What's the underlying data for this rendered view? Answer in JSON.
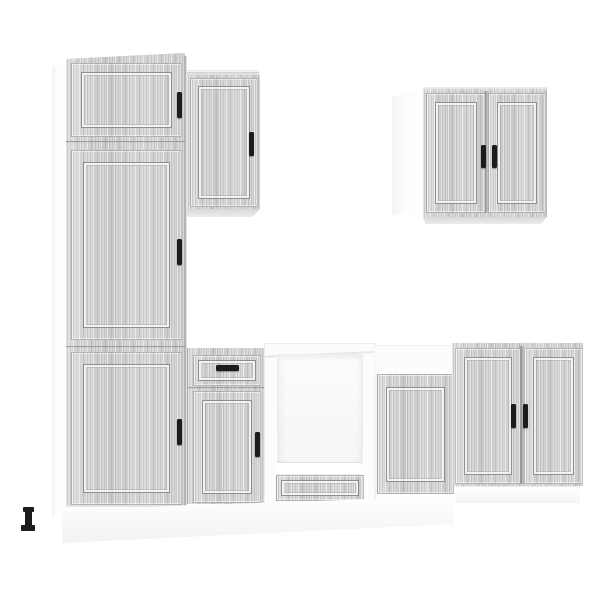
{
  "scene": {
    "description": "Product photo of a 7-piece kitchen cabinet set in grey sonoma wood-grain finish with white carcasses, on a plain white background",
    "text_visible": "none"
  },
  "colors": {
    "background": "#ffffff",
    "wood_base": "#cdcdcd",
    "wood_streak_light": "#e2e2e2",
    "wood_streak_dark": "#aeaeae",
    "carcass_white": "#fcfcfc",
    "panel_groove": "#8f8f8f",
    "underside_shadow": "#d8d8d8",
    "handle_black": "#1c1c1c",
    "plinth_white": "#f5f5f5"
  },
  "units": [
    {
      "id": "tall-pantry-cabinet",
      "position": "far left, full height",
      "doors": 3,
      "drawers": 0,
      "handles": 3
    },
    {
      "id": "wall-cabinet-single-door",
      "position": "upper, right of tall cabinet",
      "doors": 1,
      "drawers": 0,
      "handles": 1
    },
    {
      "id": "wall-cabinet-double-door",
      "position": "upper right",
      "doors": 2,
      "drawers": 0,
      "handles": 2
    },
    {
      "id": "base-cabinet-drawer-door",
      "position": "lower, right of tall cabinet",
      "doors": 1,
      "drawers": 1,
      "handles": 2
    },
    {
      "id": "oven-housing-cabinet",
      "position": "lower center, white with open niche",
      "doors": 0,
      "drawers": 1,
      "handles": 0
    },
    {
      "id": "base-cabinet-single-door",
      "position": "lower, right of oven housing",
      "doors": 1,
      "drawers": 0,
      "handles": 0
    },
    {
      "id": "base-cabinet-double-door",
      "position": "lower right",
      "doors": 2,
      "drawers": 0,
      "handles": 2
    }
  ],
  "details": {
    "adjustable_foot": "single black leveling foot visible under front-left of tall cabinet",
    "plinth": "white kickboard strip beneath the base cabinets"
  }
}
